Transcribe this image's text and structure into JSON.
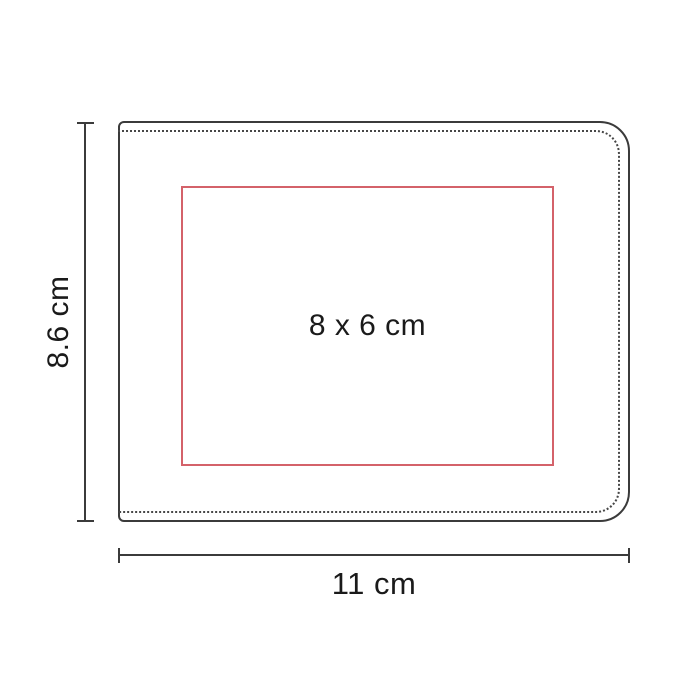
{
  "diagram": {
    "title": "product-print-area-dimension-diagram",
    "product_shape": "bi-fold wallet outline with stitch line",
    "print_area": {
      "label": "8 x 6 cm",
      "border_color": "#d4626a"
    },
    "height_dimension": {
      "label": "8.6 cm"
    },
    "width_dimension": {
      "label": "11 cm"
    },
    "colors": {
      "background": "#ffffff",
      "outline": "#3b3b3b",
      "stitch_line": "#474747",
      "print_area_border": "#d4626a",
      "label_text": "#1a1a1a"
    }
  }
}
